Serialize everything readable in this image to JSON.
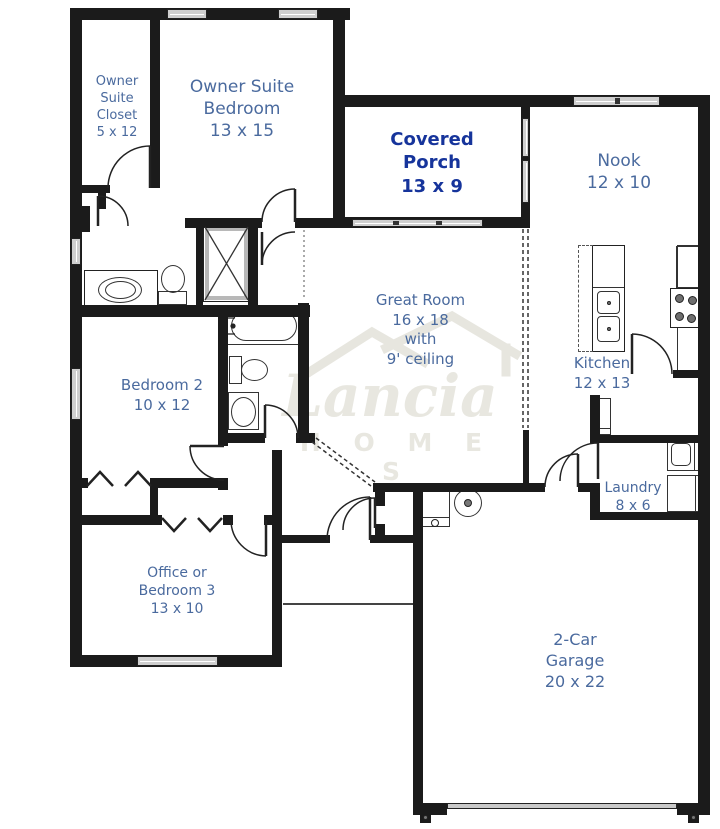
{
  "title": "Lancia Homes floor plan",
  "brand": {
    "name": "Lancia",
    "word": "H O M E S"
  },
  "colors": {
    "label_blue": "#4a6a9e",
    "porch_navy": "#16349b",
    "wall": "#1b1b1b",
    "watermark": "#e8e7e0",
    "window_fill": "#cfcfcf"
  },
  "rooms": [
    {
      "key": "owner-suite-closet",
      "lines": [
        "Owner",
        "Suite",
        "Closet",
        "5 x 12"
      ]
    },
    {
      "key": "owner-suite-bedroom",
      "lines": [
        "Owner Suite",
        "Bedroom",
        "13 x 15"
      ]
    },
    {
      "key": "covered-porch",
      "lines": [
        "Covered",
        "Porch",
        "13 x 9"
      ]
    },
    {
      "key": "nook",
      "lines": [
        "Nook",
        "12 x 10"
      ]
    },
    {
      "key": "great-room",
      "lines": [
        "Great Room",
        "16 x 18",
        "with",
        "9' ceiling"
      ]
    },
    {
      "key": "kitchen",
      "lines": [
        "Kitchen",
        "12 x 13"
      ]
    },
    {
      "key": "bedroom-2",
      "lines": [
        "Bedroom 2",
        "10 x 12"
      ]
    },
    {
      "key": "laundry",
      "lines": [
        "Laundry",
        "8 x 6"
      ]
    },
    {
      "key": "office-or-bedroom-3",
      "lines": [
        "Office or",
        "Bedroom 3",
        "13 x 10"
      ]
    },
    {
      "key": "two-car-garage",
      "lines": [
        "2-Car",
        "Garage",
        "20 x 22"
      ]
    }
  ]
}
